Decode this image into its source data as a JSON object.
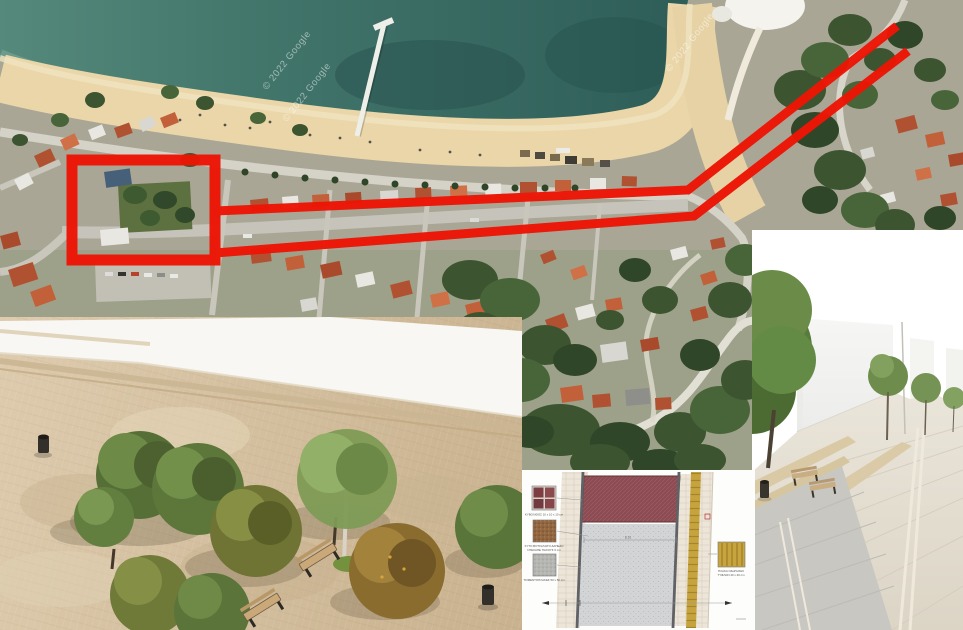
{
  "map": {
    "watermark": "© 2022 Google",
    "annotation_color": "#ed1505"
  },
  "plan": {
    "dimension_label": "8.10",
    "legend": [
      {
        "name": "cobblestone-swatch",
        "label": "ΚΥΒΟΛΙΘΟΣ 10 x 10 x 10 cm"
      },
      {
        "name": "gravel-swatch",
        "label": "ΧΥΤΟ ΒΟΤΣΑΛΩΤΟ ΔΑΠΕΔΟ",
        "label2": "ΝΤΕΚΑΠΕ ΠΑΧΟΥΣ 6 cm"
      },
      {
        "name": "concrete-slab-swatch",
        "label": "ΤΣΙΜΕΝΤΟΠΛΑΚΕΣ 50 x 50 cm"
      },
      {
        "name": "tactile-paving-swatch",
        "label": "ΠΛΑΚΑ ΟΔΗΓΗΣΗΣ",
        "label2": "ΤΥΦΛΩΝ 40 x 40 cm"
      }
    ]
  }
}
